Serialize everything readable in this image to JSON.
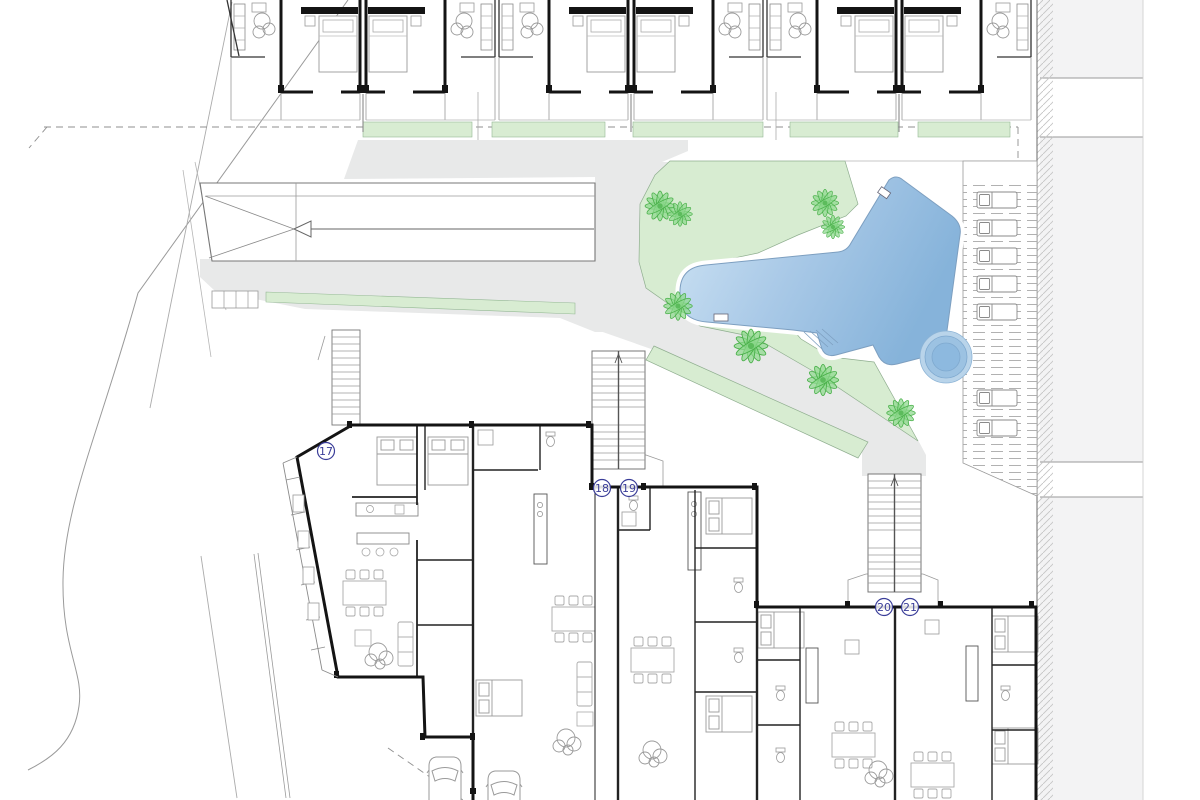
{
  "plan": {
    "type": "architectural-site-plan",
    "level": "ground-floor",
    "unit_labels": [
      "17",
      "18",
      "19",
      "20",
      "21"
    ],
    "areas": {
      "pool": "swimming-pool",
      "spa": "round-spa",
      "deck": "sun-deck-with-loungers",
      "garden": "pool-garden",
      "ramp": "garage-ramp",
      "road": "street-boundary",
      "parking": "parking-spaces",
      "stairs": "communal-stairs",
      "townhouses": "upper-townhouse-row",
      "apartments": "lower-apartment-block"
    },
    "colors": {
      "pool_light": "#cfe4f4",
      "pool_dark": "#86b3da",
      "garden_green": "#d7ecd1",
      "strip_green": "#d8ecd2",
      "tree_green": "#49b049",
      "path_gray": "#e8e9e9",
      "sidewalk_gray": "#f3f3f4",
      "wall_black": "#141414",
      "label_blue": "#3b3e99",
      "hatch_gray": "#c5c5c5"
    }
  }
}
